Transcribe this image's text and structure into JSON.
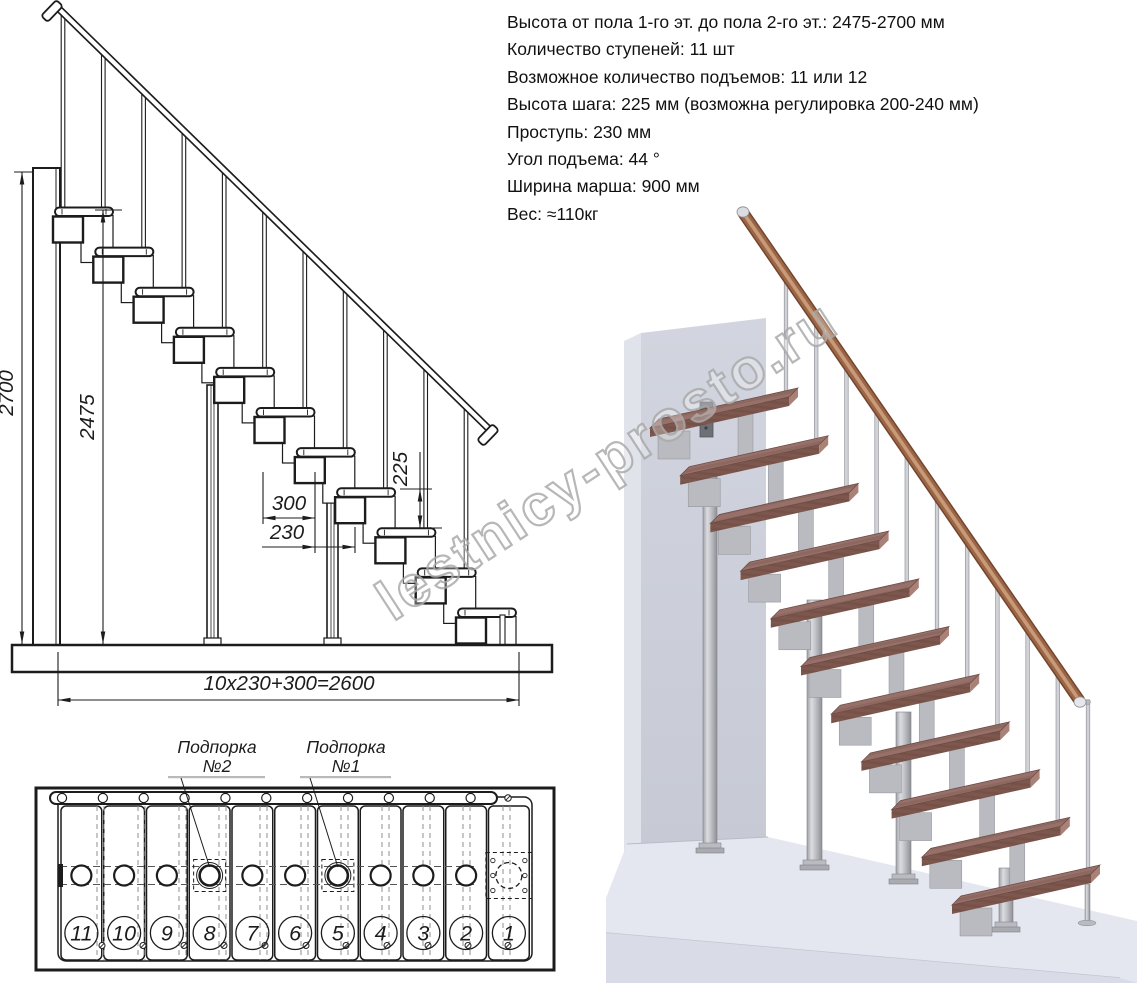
{
  "specs": {
    "lines": [
      "Высота от пола 1-го эт. до пола 2-го эт.: 2475-2700 мм",
      "Количество ступеней: 11 шт",
      "Возможное количество подъемов: 11 или 12",
      "Высота шага: 225 мм (возможна регулировка 200-240 мм)",
      "Проступь: 230 мм",
      "Угол подъема: 44 °",
      "Ширина марша: 900 мм",
      "Вес: ≈110кг"
    ]
  },
  "side_view": {
    "steps": 11,
    "dim_total_height": "2700",
    "dim_to_top_step": "2475",
    "dim_rise": "225",
    "dim_module": "300",
    "dim_going": "230",
    "dim_length": "10x230+300=2600"
  },
  "plan_view": {
    "step_numbers": [
      "11",
      "10",
      "9",
      "8",
      "7",
      "6",
      "5",
      "4",
      "3",
      "2",
      "1"
    ],
    "support_label_2": {
      "line1": "Подпорка",
      "line2": "№2"
    },
    "support_label_1": {
      "line1": "Подпорка",
      "line2": "№1"
    }
  },
  "watermark": "lestnicy-prosto.ru",
  "colors": {
    "ink": "#1c1c1c",
    "dash_gray": "#8f8f8f",
    "watermark_gray": "#ababab",
    "wood_top": "#97706a",
    "wood_top_dark": "#826057",
    "wood_front": "#7d574e",
    "wood_front_dark": "#6f4c44",
    "wood_end": "#aa8176",
    "metal_mid": "#b9bbc1",
    "metal_dark": "#8f9197",
    "wall_front_a": "#d2d5df",
    "wall_front_b": "#c7cad5",
    "wall_side": "#e0e3ea",
    "slab_top": "#e4e7f0",
    "slab_front": "#d9dce6",
    "rail_core": "#9a6647",
    "rail_highlight": "#c89a78",
    "rail_shadow": "#74452c",
    "cap_silver": "#dcdde1"
  }
}
